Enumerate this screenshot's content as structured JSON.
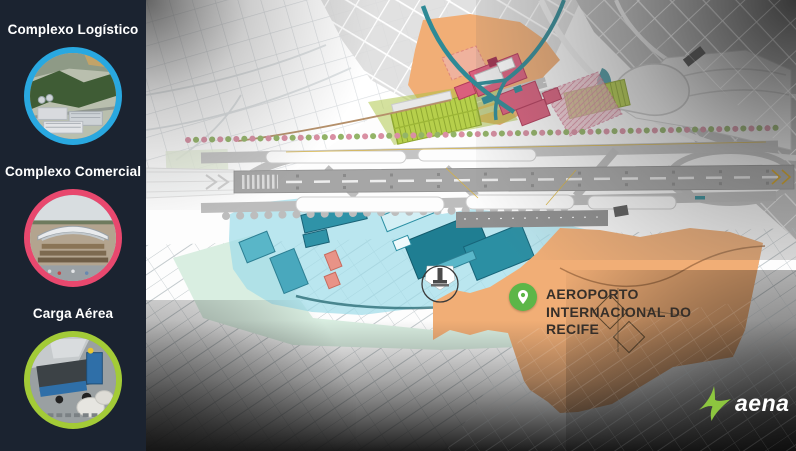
{
  "sidebar": {
    "items": [
      {
        "label": "Complexo Logístico",
        "photo": "aerial-logistics-park-photo"
      },
      {
        "label": "Complexo Comercial",
        "photo": "aerial-commercial-complex-photo"
      },
      {
        "label": "Carga Aérea",
        "photo": "air-cargo-loader-photo"
      }
    ]
  },
  "map": {
    "airport_label": {
      "lines": [
        "AEROPORTO",
        "INTERNACIONAL DO",
        "RECIFE"
      ]
    }
  },
  "logo": {
    "text": "aena"
  },
  "icons": {
    "airport_pin": "location-pin-icon",
    "logo_mark": "aena-star-icon"
  },
  "colors": {
    "sidebar-bg": "#1b2330",
    "sidebar-label": "#ffffff",
    "ring-logistics": "#29a8e0",
    "ring-commercial": "#e8486e",
    "ring-cargo": "#a3cb37",
    "pin-green": "#5cb648",
    "label-text": "#362f29",
    "zone-orange": "#f1ae76",
    "zone-cyan": "#9fdde9",
    "zone-mint": "#d9eee1",
    "zone-lime": "#aac43e",
    "zone-pink": "#da5f7d",
    "teal-road": "#2e8a96",
    "aena-green": "#8dc63f"
  }
}
